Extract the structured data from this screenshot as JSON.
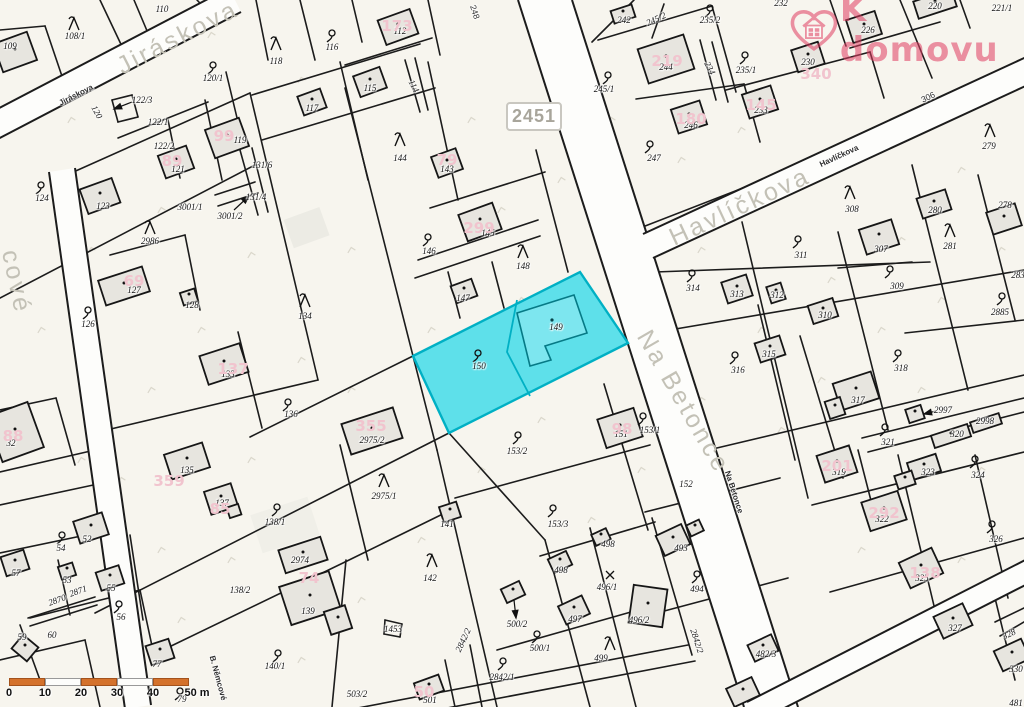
{
  "branding": {
    "logo_text": "K domovu",
    "logo_color": "#e03d62"
  },
  "map": {
    "road_badge": "2451",
    "highlight": {
      "parcel": "150",
      "building_parcel": "149",
      "fill": "#4ddee9",
      "stroke": "#00b0c4"
    },
    "scale_bar": {
      "labels": [
        "0",
        "10",
        "20",
        "30",
        "40",
        "50 m"
      ],
      "bar_color": "#d4722c"
    },
    "streets": [
      {
        "t": "Jiráskova",
        "x": 178,
        "y": 38,
        "rot": -27,
        "cls": "big"
      },
      {
        "t": "Jiráskova",
        "x": 76,
        "y": 95,
        "rot": -27,
        "cls": "small"
      },
      {
        "t": "cové",
        "x": 16,
        "y": 282,
        "rot": 78,
        "cls": "big"
      },
      {
        "t": "B. Němcové",
        "x": 218,
        "y": 678,
        "rot": 75,
        "cls": "small"
      },
      {
        "t": "Na Betonce",
        "x": 683,
        "y": 402,
        "rot": 60,
        "cls": "big"
      },
      {
        "t": "Na Betonce",
        "x": 734,
        "y": 492,
        "rot": 72,
        "cls": "small"
      },
      {
        "t": "Havlíčkova",
        "x": 740,
        "y": 207,
        "rot": -25,
        "cls": "big"
      },
      {
        "t": "Havlíčkova",
        "x": 839,
        "y": 156,
        "rot": -25,
        "cls": "small"
      }
    ],
    "road_numbers": [
      [
        "248",
        475,
        12,
        72
      ],
      [
        "306",
        928,
        97,
        -25
      ]
    ],
    "parcel_labels": [
      [
        "109",
        10,
        46
      ],
      [
        "108/1",
        75,
        36
      ],
      [
        "110",
        162,
        9
      ],
      [
        "116",
        332,
        47
      ],
      [
        "118",
        276,
        61
      ],
      [
        "112",
        400,
        31
      ],
      [
        "115",
        370,
        88
      ],
      [
        "117",
        312,
        108
      ],
      [
        "114",
        414,
        86,
        62
      ],
      [
        "120/1",
        213,
        78
      ],
      [
        "122/3",
        142,
        100
      ],
      [
        "120",
        97,
        112,
        62
      ],
      [
        "122/1",
        158,
        122
      ],
      [
        "122/2",
        164,
        146
      ],
      [
        "121",
        178,
        169
      ],
      [
        "119",
        240,
        140
      ],
      [
        "124",
        42,
        198
      ],
      [
        "123",
        103,
        206
      ],
      [
        "3001/1",
        190,
        207
      ],
      [
        "3001/2",
        230,
        216
      ],
      [
        "131/6",
        262,
        165
      ],
      [
        "131/4",
        256,
        197
      ],
      [
        "2986",
        150,
        241
      ],
      [
        "127",
        134,
        290
      ],
      [
        "128",
        192,
        305
      ],
      [
        "126",
        88,
        324
      ],
      [
        "134",
        305,
        316
      ],
      [
        "133",
        228,
        374
      ],
      [
        "136",
        291,
        414
      ],
      [
        "144",
        400,
        158
      ],
      [
        "143",
        447,
        169
      ],
      [
        "145",
        488,
        233
      ],
      [
        "146",
        429,
        251
      ],
      [
        "147",
        463,
        298
      ],
      [
        "148",
        523,
        266
      ],
      [
        "149",
        556,
        327
      ],
      [
        "150",
        479,
        366
      ],
      [
        "2975/2",
        372,
        440
      ],
      [
        "2975/1",
        384,
        496
      ],
      [
        "135",
        187,
        470
      ],
      [
        "137",
        222,
        503
      ],
      [
        "138/1",
        275,
        522
      ],
      [
        "141",
        447,
        524
      ],
      [
        "142",
        430,
        578
      ],
      [
        "2974",
        300,
        560
      ],
      [
        "139",
        308,
        611
      ],
      [
        "138/2",
        240,
        590
      ],
      [
        "140/1",
        275,
        666
      ],
      [
        "1453",
        393,
        629
      ],
      [
        "153/2",
        517,
        451
      ],
      [
        "153/3",
        558,
        524
      ],
      [
        "153/1",
        650,
        430
      ],
      [
        "151",
        621,
        434
      ],
      [
        "152",
        686,
        484
      ],
      [
        "32",
        11,
        443
      ],
      [
        "52",
        87,
        539
      ],
      [
        "54",
        61,
        548
      ],
      [
        "57",
        16,
        573
      ],
      [
        "53",
        67,
        580
      ],
      [
        "55",
        111,
        588
      ],
      [
        "2870",
        57,
        600,
        -20
      ],
      [
        "2871",
        78,
        591,
        -20
      ],
      [
        "56",
        121,
        617
      ],
      [
        "59",
        22,
        637
      ],
      [
        "60",
        52,
        635
      ],
      [
        "77",
        157,
        664
      ],
      [
        "79",
        182,
        699
      ],
      [
        "503/2",
        357,
        694
      ],
      [
        "501",
        430,
        700
      ],
      [
        "2842/1",
        502,
        677
      ],
      [
        "2842/2",
        463,
        640,
        -65
      ],
      [
        "2842/2",
        697,
        641,
        72
      ],
      [
        "500/2",
        517,
        624
      ],
      [
        "500/1",
        540,
        648
      ],
      [
        "498",
        561,
        570
      ],
      [
        "498",
        608,
        544
      ],
      [
        "497",
        575,
        619
      ],
      [
        "496/1",
        607,
        587
      ],
      [
        "496/2",
        639,
        620
      ],
      [
        "499",
        601,
        658
      ],
      [
        "493",
        681,
        548
      ],
      [
        "494",
        697,
        589
      ],
      [
        "482/3",
        766,
        654
      ],
      [
        "481",
        1016,
        703
      ],
      [
        "242",
        624,
        20
      ],
      [
        "245/2",
        656,
        19,
        -25
      ],
      [
        "244",
        666,
        67
      ],
      [
        "235/2",
        710,
        20
      ],
      [
        "232",
        781,
        3
      ],
      [
        "235/1",
        746,
        70
      ],
      [
        "233",
        761,
        110
      ],
      [
        "230",
        808,
        62
      ],
      [
        "226",
        868,
        30
      ],
      [
        "220",
        935,
        6
      ],
      [
        "221/1",
        1002,
        8
      ],
      [
        "245/1",
        604,
        89
      ],
      [
        "246",
        691,
        125
      ],
      [
        "247",
        654,
        158
      ],
      [
        "234",
        710,
        68,
        62
      ],
      [
        "308",
        852,
        209
      ],
      [
        "311",
        801,
        255
      ],
      [
        "307",
        881,
        249
      ],
      [
        "309",
        897,
        286
      ],
      [
        "314",
        693,
        288
      ],
      [
        "313",
        737,
        294
      ],
      [
        "312",
        777,
        295
      ],
      [
        "310",
        825,
        315
      ],
      [
        "280",
        935,
        210
      ],
      [
        "281",
        950,
        246
      ],
      [
        "278",
        1005,
        205
      ],
      [
        "279",
        989,
        146
      ],
      [
        "2885",
        1000,
        312
      ],
      [
        "283",
        1018,
        275
      ],
      [
        "315",
        769,
        354
      ],
      [
        "316",
        738,
        370
      ],
      [
        "318",
        901,
        368
      ],
      [
        "317",
        858,
        400
      ],
      [
        "2997",
        943,
        410
      ],
      [
        "2998",
        985,
        421
      ],
      [
        "320",
        957,
        434
      ],
      [
        "321",
        888,
        442
      ],
      [
        "319",
        839,
        472
      ],
      [
        "323",
        928,
        472
      ],
      [
        "324",
        978,
        475
      ],
      [
        "322",
        882,
        519
      ],
      [
        "326",
        996,
        539
      ],
      [
        "325",
        922,
        578
      ],
      [
        "327",
        955,
        628
      ],
      [
        "328",
        1009,
        634,
        -25
      ],
      [
        "330",
        1016,
        669
      ]
    ],
    "house_numbers": [
      [
        "99",
        224,
        136
      ],
      [
        "89",
        172,
        161
      ],
      [
        "173",
        397,
        26
      ],
      [
        "79",
        447,
        160
      ],
      [
        "299",
        479,
        228
      ],
      [
        "69",
        134,
        281
      ],
      [
        "137",
        233,
        369
      ],
      [
        "359",
        169,
        481
      ],
      [
        "85",
        220,
        509
      ],
      [
        "355",
        371,
        426
      ],
      [
        "74",
        309,
        578
      ],
      [
        "88",
        13,
        436
      ],
      [
        "98",
        622,
        429
      ],
      [
        "50",
        424,
        692
      ],
      [
        "219",
        667,
        61
      ],
      [
        "145",
        761,
        105
      ],
      [
        "180",
        691,
        119
      ],
      [
        "340",
        816,
        74
      ],
      [
        "201",
        837,
        466
      ],
      [
        "292",
        884,
        513
      ],
      [
        "138",
        925,
        573
      ]
    ],
    "symbols": {
      "hook": [
        [
          332,
          36
        ],
        [
          213,
          68
        ],
        [
          41,
          188
        ],
        [
          88,
          313
        ],
        [
          288,
          405
        ],
        [
          277,
          510
        ],
        [
          428,
          240
        ],
        [
          478,
          356
        ],
        [
          518,
          438
        ],
        [
          553,
          511
        ],
        [
          537,
          637
        ],
        [
          503,
          664
        ],
        [
          278,
          656
        ],
        [
          119,
          607
        ],
        [
          62,
          538
        ],
        [
          180,
          694
        ],
        [
          608,
          78
        ],
        [
          650,
          147
        ],
        [
          710,
          11
        ],
        [
          745,
          58
        ],
        [
          798,
          242
        ],
        [
          692,
          276
        ],
        [
          890,
          272
        ],
        [
          735,
          358
        ],
        [
          898,
          356
        ],
        [
          885,
          430
        ],
        [
          975,
          462
        ],
        [
          992,
          527
        ],
        [
          1002,
          299
        ],
        [
          643,
          419
        ],
        [
          697,
          577
        ]
      ],
      "tree": [
        [
          74,
          24
        ],
        [
          276,
          44
        ],
        [
          400,
          140
        ],
        [
          150,
          228
        ],
        [
          305,
          301
        ],
        [
          523,
          252
        ],
        [
          384,
          481
        ],
        [
          432,
          561
        ],
        [
          610,
          644
        ],
        [
          850,
          193
        ],
        [
          950,
          231
        ],
        [
          990,
          131
        ]
      ],
      "cross": [
        [
          610,
          575
        ]
      ]
    }
  }
}
